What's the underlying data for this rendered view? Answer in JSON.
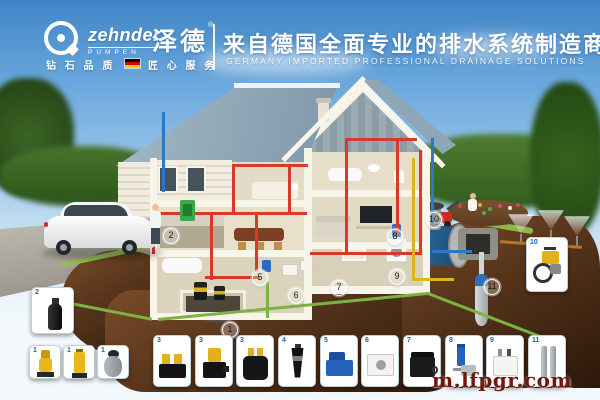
{
  "header": {
    "brand_icon": "zehnder-swirl-logo",
    "brand_name": "zehnder",
    "brand_sub": "PUMPEN",
    "brand_cn": "泽德",
    "brand_reg": "®",
    "tagline_left": "钻 石 品 质",
    "tagline_right": "匠 心 服 务",
    "title_cn": "来自德国全面专业的排水系统制造商",
    "title_en": "GERMANY IMPORTED PROFESSIONAL DRAINAGE SOLUTIONS"
  },
  "scene": {
    "description": "cutaway house showing Zehnder drainage pump installation points",
    "markers": [
      {
        "n": "1"
      },
      {
        "n": "2"
      },
      {
        "n": "5"
      },
      {
        "n": "6"
      },
      {
        "n": "7"
      },
      {
        "n": "8"
      },
      {
        "n": "9"
      },
      {
        "n": "10"
      },
      {
        "n": "11"
      }
    ]
  },
  "products": {
    "left_top": {
      "n": "2",
      "item": "submersible-drainage-pump-black"
    },
    "left_row": [
      {
        "n": "1",
        "item": "yellow-sump-pump"
      },
      {
        "n": "1",
        "item": "yellow-sump-pump-tall"
      },
      {
        "n": "1",
        "item": "grey-collecting-tank"
      }
    ],
    "bottom_row": [
      {
        "n": "3",
        "item": "twin-pump-lifting-station"
      },
      {
        "n": "3",
        "item": "yellow-black-lifting-pump"
      },
      {
        "n": "3",
        "item": "black-tank-two-yellow-caps"
      },
      {
        "n": "4",
        "item": "cone-submersible-pump"
      },
      {
        "n": "5",
        "item": "blue-compact-lifting-station"
      },
      {
        "n": "6",
        "item": "white-box-unit"
      },
      {
        "n": "7",
        "item": "black-storage-tank"
      },
      {
        "n": "8",
        "item": "blue-cylinder-pressure-pump"
      },
      {
        "n": "9",
        "item": "white-tank-unit"
      },
      {
        "n": "11",
        "item": "stainless-deep-well-pumps"
      }
    ],
    "garden_card": {
      "n": "10",
      "item": "garden-irrigation-pump"
    }
  },
  "watermark": "m.lfpgr.com",
  "colors": {
    "pipe_red": "#d8392b",
    "pipe_green": "#7cb342",
    "pipe_blue": "#2979c8",
    "pipe_yellow": "#dcb41e",
    "card_number_blue": "#1462b8",
    "watermark_red": "#701710",
    "flag_stripes": [
      "#000000",
      "#dd0000",
      "#ffce00"
    ]
  }
}
